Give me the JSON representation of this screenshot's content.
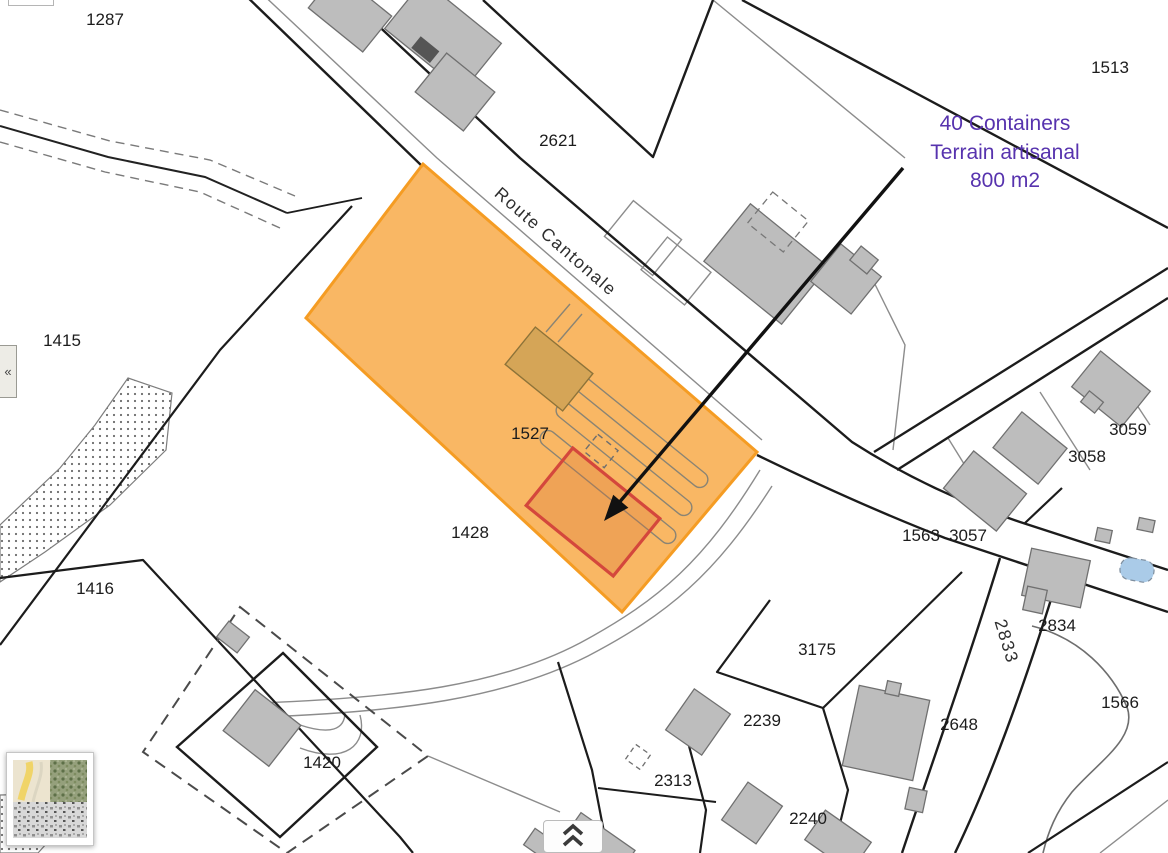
{
  "map": {
    "background": "#ffffff",
    "highlight": {
      "parcel_id": "1527",
      "fill": "#F8B157",
      "stroke": "#F59C23",
      "label_color": "#BF8C28",
      "selection_stroke": "#D4473C"
    },
    "annotation": {
      "lines": [
        "40 Containers",
        "Terrain artisanal",
        "800 m2"
      ],
      "color": "#5733AE"
    },
    "labels": [
      {
        "text": "1287",
        "x": 105,
        "y": 25
      },
      {
        "text": "2621",
        "x": 558,
        "y": 146
      },
      {
        "text": "1513",
        "x": 1110,
        "y": 73
      },
      {
        "text": "1415",
        "x": 62,
        "y": 346
      },
      {
        "text": "1416",
        "x": 95,
        "y": 594
      },
      {
        "text": "1428",
        "x": 470,
        "y": 538
      },
      {
        "text": "1527",
        "x": 530,
        "y": 439,
        "color": "#BF8C28"
      },
      {
        "text": "3059",
        "x": 1128,
        "y": 435
      },
      {
        "text": "3058",
        "x": 1087,
        "y": 462
      },
      {
        "text": "1563",
        "x": 921,
        "y": 541
      },
      {
        "text": "3057",
        "x": 968,
        "y": 541
      },
      {
        "text": "2834",
        "x": 1057,
        "y": 631
      },
      {
        "text": "1566",
        "x": 1120,
        "y": 708
      },
      {
        "text": "3175",
        "x": 817,
        "y": 655
      },
      {
        "text": "2239",
        "x": 762,
        "y": 726
      },
      {
        "text": "2648",
        "x": 959,
        "y": 730
      },
      {
        "text": "2313",
        "x": 673,
        "y": 786
      },
      {
        "text": "2240",
        "x": 808,
        "y": 824
      },
      {
        "text": "1420",
        "x": 322,
        "y": 768
      },
      {
        "text": "2833",
        "x": 1001,
        "y": 643,
        "rotate": 73,
        "street": true
      },
      {
        "text": "Route Cantonale",
        "x": 552,
        "y": 246,
        "rotate": 41,
        "street": true
      }
    ],
    "pond_color": "#AACBE8"
  },
  "controls": {
    "collapse_left_glyph": "«"
  }
}
